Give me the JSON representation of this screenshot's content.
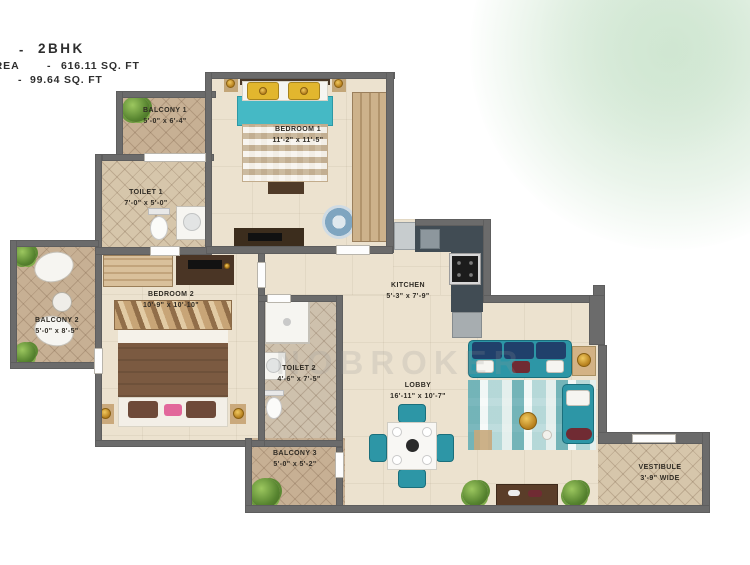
{
  "header": {
    "dash": "-",
    "title": "2BHK",
    "area_label": "AREA",
    "area_dash": "-",
    "area_value": "616.11 SQ. FT",
    "area2_dash": "-",
    "area2_value": "99.64 SQ. FT"
  },
  "watermark": "NOBROKER",
  "rooms": {
    "balcony1": {
      "name": "BALCONY 1",
      "dims": "5'-0\" x 6'-4\""
    },
    "bedroom1": {
      "name": "BEDROOM 1",
      "dims": "11'-2\" x 11'-5\""
    },
    "toilet1": {
      "name": "TOILET 1",
      "dims": "7'-0\" x 5'-0\""
    },
    "balcony2": {
      "name": "BALCONY 2",
      "dims": "5'-0\" x 8'-5\""
    },
    "bedroom2": {
      "name": "BEDROOM 2",
      "dims": "10'-9\" x 10'-10\""
    },
    "kitchen": {
      "name": "KITCHEN",
      "dims": "5'-3\" x 7'-9\""
    },
    "toilet2": {
      "name": "TOILET 2",
      "dims": "4'-6\" x 7'-5\""
    },
    "lobby": {
      "name": "LOBBY",
      "dims": "16'-11\" x 10'-7\""
    },
    "balcony3": {
      "name": "BALCONY 3",
      "dims": "5'-0\" x 5'-2\""
    },
    "vestibule": {
      "name": "VESTIBULE",
      "dims": "3'-9\" WIDE"
    }
  },
  "colors": {
    "wall": "#6b6b6b",
    "floor_beige": "#ece2cf",
    "balcony_tile": "#c7b094",
    "accent_teal": "#2d96a6",
    "bed1_blanket": "#45b9c5",
    "pillow_yellow": "#e2b62e",
    "bed2_blanket": "#7b5a41",
    "counter_slate": "#414c54",
    "corner_glow_green": "#cde4cd"
  }
}
